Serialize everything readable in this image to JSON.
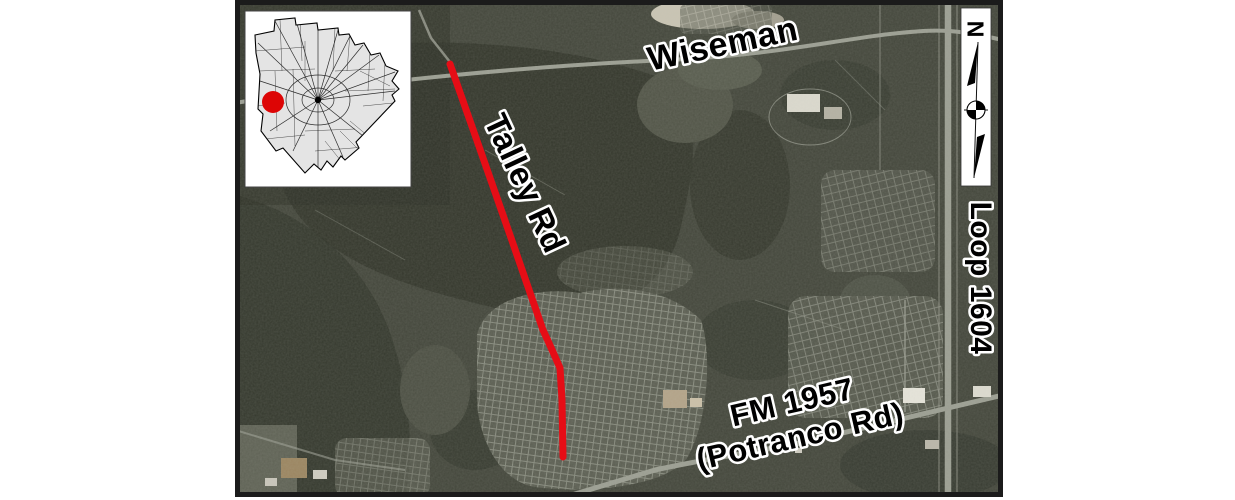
{
  "map": {
    "labels": {
      "wiseman": "Wiseman",
      "talley_rd": "Talley Rd",
      "fm1957_line1": "FM 1957",
      "fm1957_line2": "(Potranco Rd)",
      "loop_1604": "Loop 1604"
    },
    "north_arrow": {
      "letter": "N"
    },
    "colors": {
      "project_line": "#e60d16",
      "inset_marker": "#dd0505",
      "label_text": "#000000",
      "label_halo": "#ffffff"
    }
  }
}
